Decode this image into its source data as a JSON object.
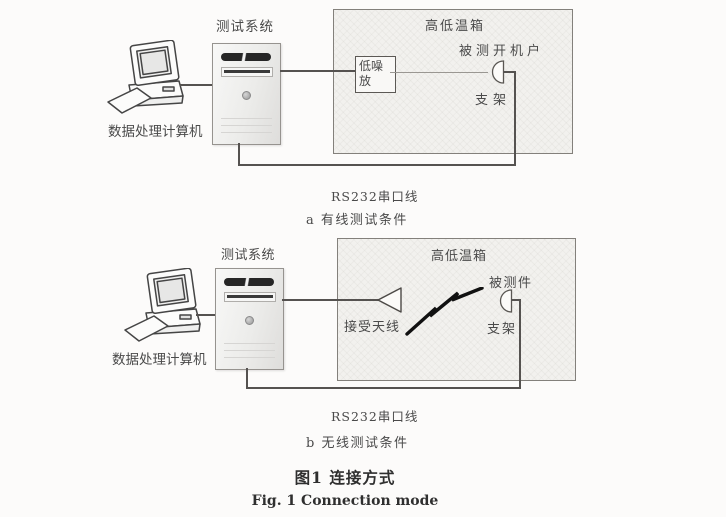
{
  "figure": {
    "caption_cn": "图1  连接方式",
    "caption_en": "Fig. 1  Connection mode"
  },
  "colors": {
    "line": "#555250",
    "chamber_fill": "#f2f1ee",
    "paper": "#fcfbfa",
    "lightning": "#111111"
  },
  "diagram_a": {
    "computer_label": "数据处理计算机",
    "test_system_label": "测试系统",
    "chamber_label": "高低温箱",
    "lna_line1": "低噪",
    "lna_line2": "放",
    "dut_label": "被测开机户",
    "bracket_label": "支架",
    "serial_label": "RS232串口线",
    "subcaption": "a  有线测试条件"
  },
  "diagram_b": {
    "computer_label": "数据处理计算机",
    "test_system_label": "测试系统",
    "chamber_label": "高低温箱",
    "antenna_label": "接受天线",
    "dut_label": "被测件",
    "bracket_label": "支架",
    "serial_label": "RS232串口线",
    "subcaption": "b  无线测试条件"
  }
}
